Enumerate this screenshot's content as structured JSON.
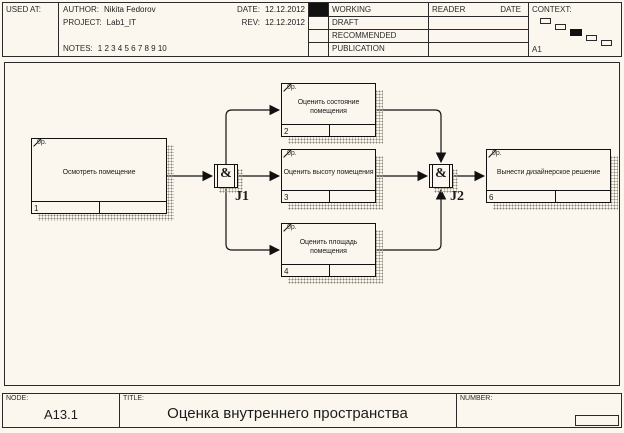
{
  "header": {
    "used_at_label": "USED AT:",
    "author_label": "AUTHOR:",
    "author": "Nikita Fedorov",
    "project_label": "PROJECT:",
    "project": "Lab1_IT",
    "notes_label": "NOTES:",
    "notes": "1 2 3 4 5 6 7 8 9 10",
    "date_label": "DATE:",
    "date": "12.12.2012",
    "rev_label": "REV:",
    "rev": "12.12.2012",
    "status_rows": [
      "WORKING",
      "DRAFT",
      "RECOMMENDED",
      "PUBLICATION"
    ],
    "reader_label": "READER",
    "reader_date_label": "DATE",
    "context_label": "CONTEXT:",
    "context_node": "A1"
  },
  "diagram": {
    "boxes": [
      {
        "id": "1",
        "label": "Осмотреть помещение",
        "cost": "0р."
      },
      {
        "id": "2",
        "label": "Оценить состояние помещения",
        "cost": "0р."
      },
      {
        "id": "3",
        "label": "Оценить высоту помещения",
        "cost": "0р."
      },
      {
        "id": "4",
        "label": "Оценить площадь помещения",
        "cost": "0р."
      },
      {
        "id": "6",
        "label": "Вынести дизайнерское решение",
        "cost": "0р."
      }
    ],
    "junctions": [
      {
        "id": "J1",
        "symbol": "&"
      },
      {
        "id": "J2",
        "symbol": "&"
      }
    ]
  },
  "footer": {
    "node_label": "NODE:",
    "node": "A13.1",
    "title_label": "TITLE:",
    "title": "Оценка внутреннего пространства",
    "number_label": "NUMBER:"
  },
  "colors": {
    "page_bg": "#fbf7ee",
    "line": "#1c1c1c",
    "shadow_stipple": "#8c8a7e",
    "status_fill": "#111111"
  }
}
